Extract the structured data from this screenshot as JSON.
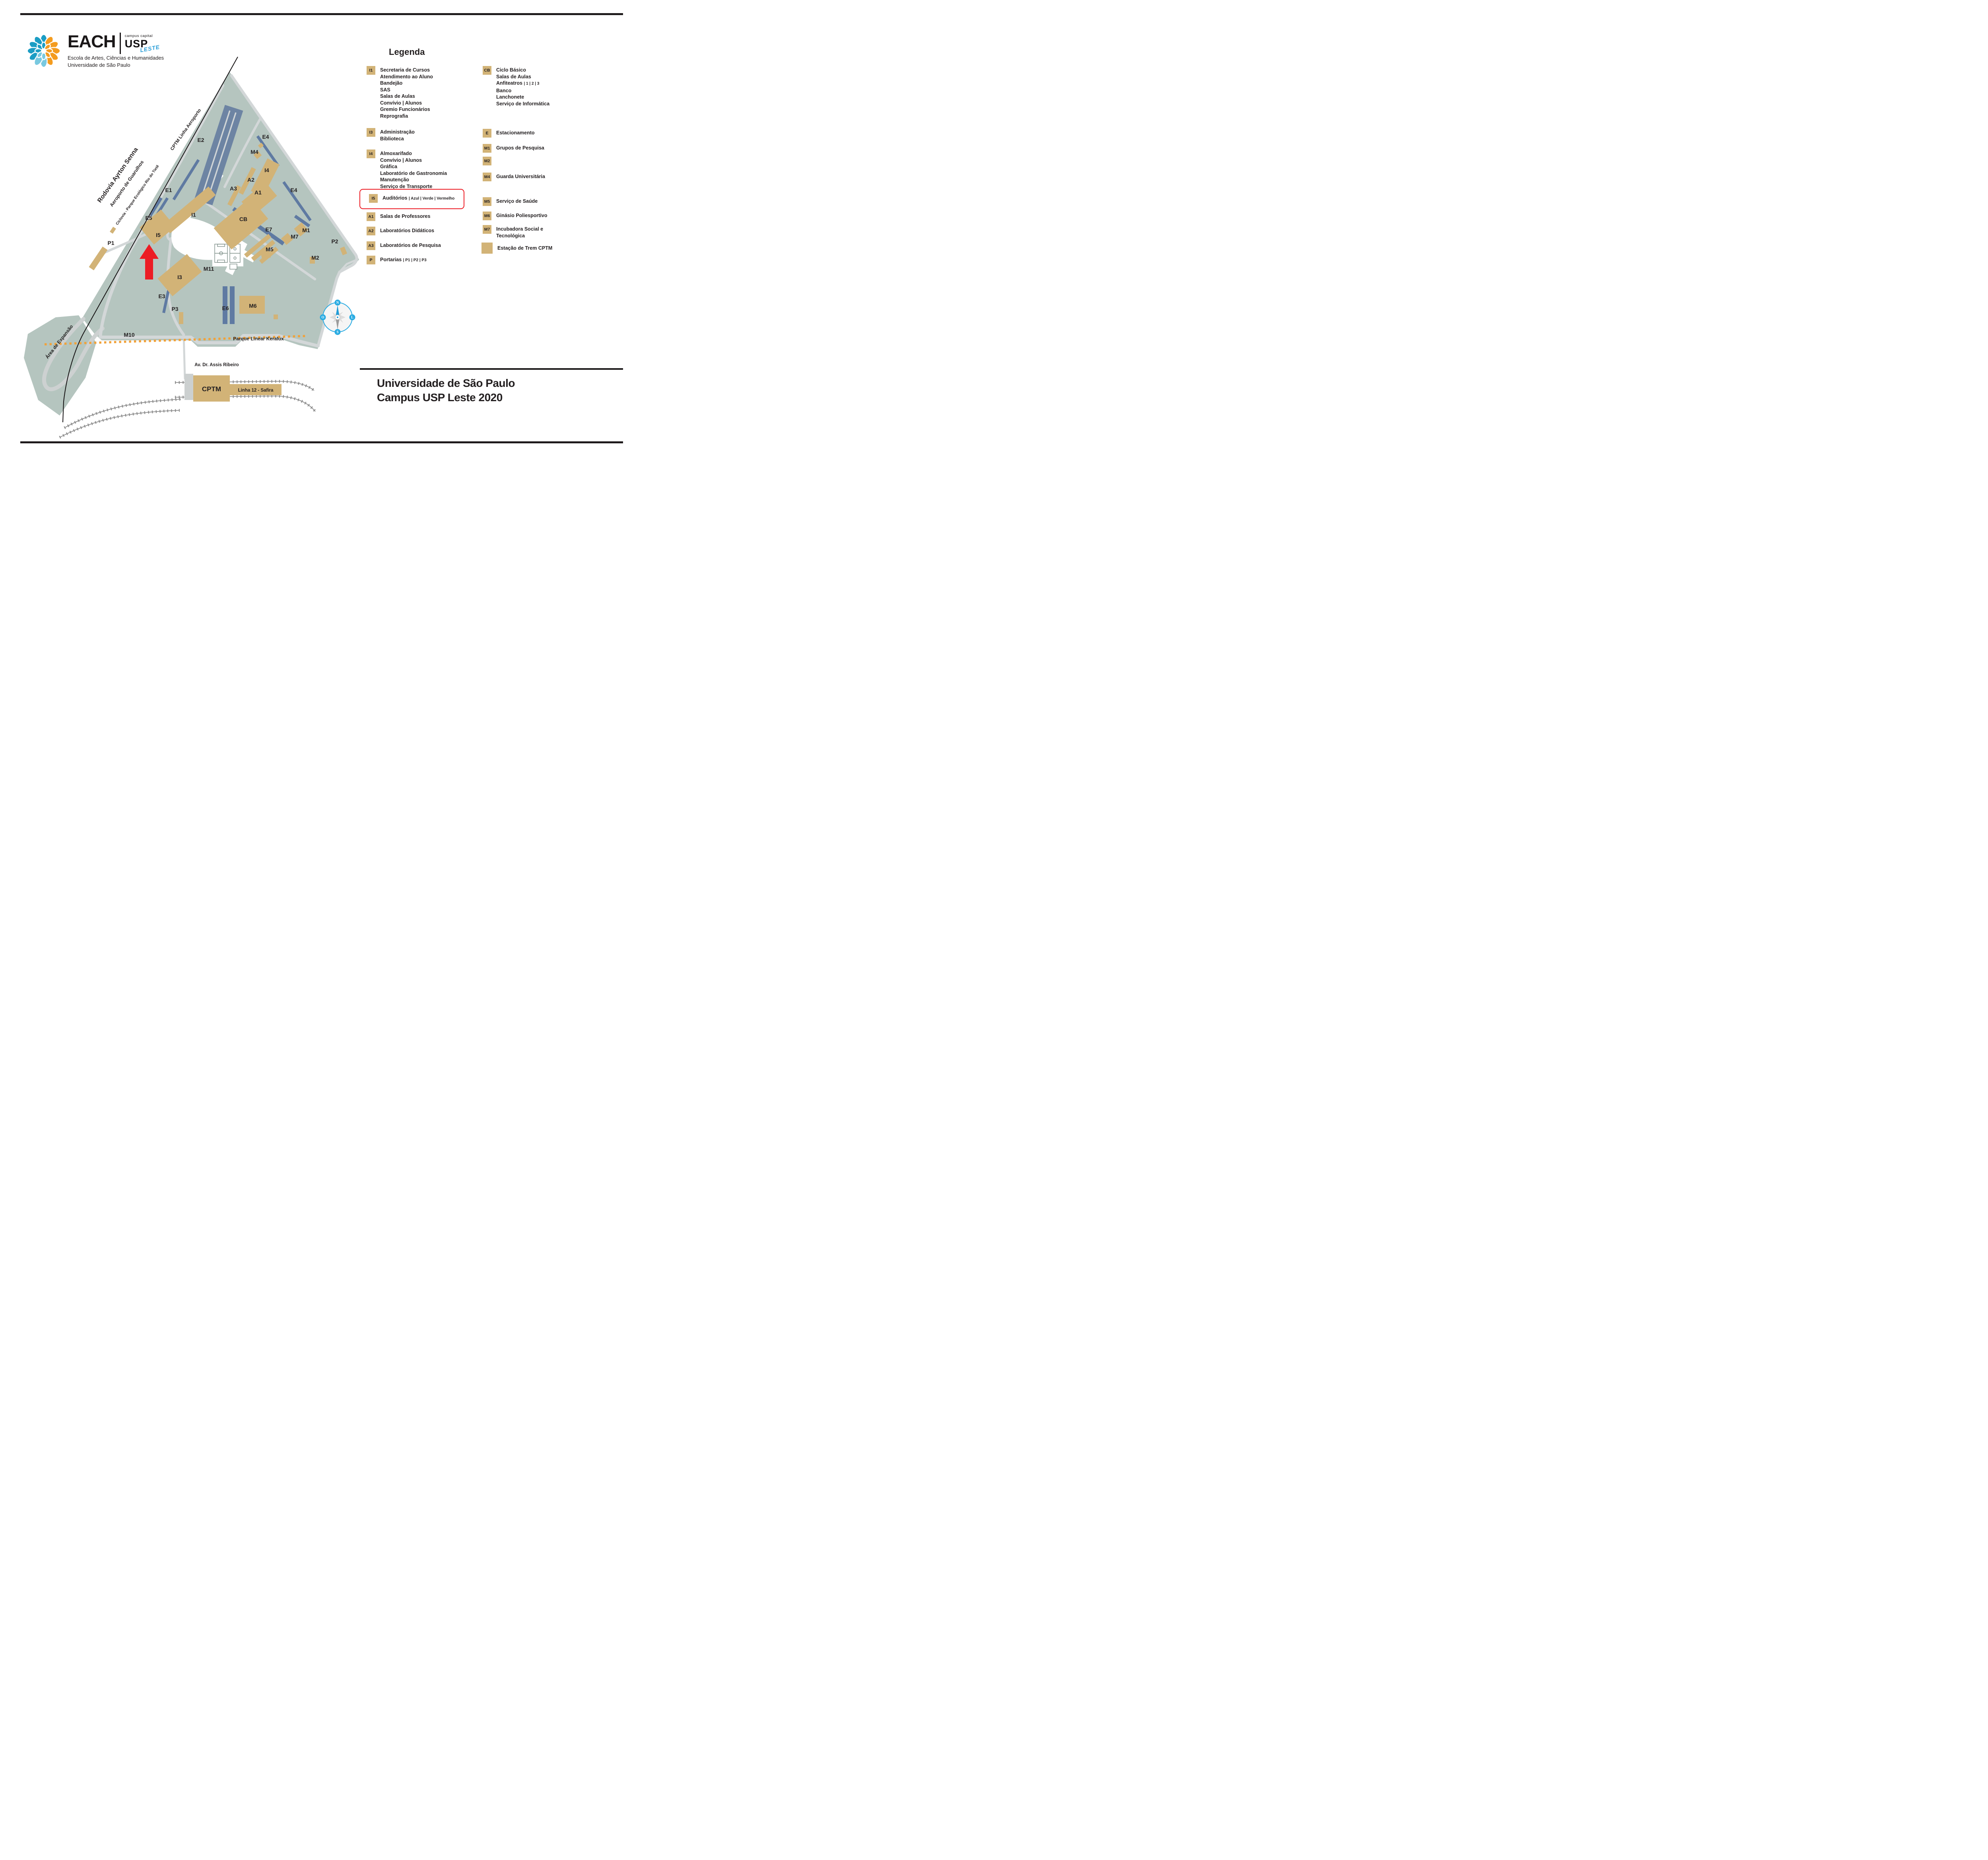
{
  "logo": {
    "acronym": "EACH",
    "campus_tag": "campus capital",
    "usp": "USP",
    "leste": "LESTE",
    "school_name": "Escola de Artes, Ciências e Humanidades",
    "university_name": "Universidade de São Paulo"
  },
  "legend": {
    "title": "Legenda",
    "col1": [
      {
        "code": "I1",
        "lines": [
          {
            "t": "Secretaria de Cursos",
            "s": ""
          },
          {
            "t": "Atendimento ao Aluno",
            "s": ""
          },
          {
            "t": "Bandejão",
            "s": ""
          },
          {
            "t": "SAS",
            "s": ""
          },
          {
            "t": "Salas de Aulas",
            "s": ""
          },
          {
            "t": "Convívio | Alunos",
            "s": ""
          },
          {
            "t": "Gremio Funcionários",
            "s": ""
          },
          {
            "t": "Reprografia",
            "s": ""
          }
        ]
      },
      {
        "code": "I3",
        "lines": [
          {
            "t": "Administração",
            "s": ""
          },
          {
            "t": "Biblioteca",
            "s": ""
          }
        ]
      },
      {
        "code": "I4",
        "lines": [
          {
            "t": "Almoxarifado",
            "s": ""
          },
          {
            "t": "Convívio | Alunos",
            "s": ""
          },
          {
            "t": "Gráfica",
            "s": ""
          },
          {
            "t": "Laboratório de Gastronomia",
            "s": ""
          },
          {
            "t": "Manutenção",
            "s": ""
          },
          {
            "t": "Serviço de Transporte",
            "s": ""
          }
        ]
      },
      {
        "code": "I5",
        "lines": [
          {
            "t": "Auditórios ",
            "s": "| Azul | Verde | Vermelho"
          }
        ],
        "highlighted": true
      },
      {
        "code": "A1",
        "lines": [
          {
            "t": "Salas de Professores",
            "s": ""
          }
        ]
      },
      {
        "code": "A2",
        "lines": [
          {
            "t": "Laboratórios Didáticos",
            "s": ""
          }
        ]
      },
      {
        "code": "A3",
        "lines": [
          {
            "t": "Laboratórios de Pesquisa",
            "s": ""
          }
        ]
      },
      {
        "code": "P",
        "lines": [
          {
            "t": "Portarias ",
            "s": "| P1 | P2 | P3"
          }
        ]
      }
    ],
    "col2": [
      {
        "code": "CB",
        "lines": [
          {
            "t": "Ciclo Básico",
            "s": ""
          },
          {
            "t": "Salas de Aulas",
            "s": ""
          },
          {
            "t": "Anfiteatros ",
            "s": "| 1 | 2 | 3"
          },
          {
            "t": "Banco",
            "s": ""
          },
          {
            "t": "Lanchonete",
            "s": ""
          },
          {
            "t": "Serviço de Informática",
            "s": ""
          }
        ]
      },
      {
        "code": "E",
        "lines": [
          {
            "t": "Estacionamento",
            "s": ""
          }
        ]
      },
      {
        "code": "M1",
        "lines": [
          {
            "t": "Grupos de Pesquisa",
            "s": ""
          }
        ]
      },
      {
        "code": "M2",
        "lines": []
      },
      {
        "code": "M4",
        "lines": [
          {
            "t": "Guarda Universitária",
            "s": ""
          }
        ]
      },
      {
        "code": "M5",
        "lines": [
          {
            "t": "Serviço de Saúde",
            "s": ""
          }
        ]
      },
      {
        "code": "M6",
        "lines": [
          {
            "t": "Ginásio Poliesportivo",
            "s": ""
          }
        ]
      },
      {
        "code": "M7",
        "lines": [
          {
            "t": "Incubadora Social e",
            "s": ""
          },
          {
            "t": "Tecnológica",
            "s": ""
          }
        ]
      },
      {
        "code": "",
        "lines": [
          {
            "t": "Estação de Trem CPTM",
            "s": ""
          }
        ]
      }
    ]
  },
  "map": {
    "labels": [
      {
        "text": "E2"
      },
      {
        "text": "E4"
      },
      {
        "text": "M4"
      },
      {
        "text": "I4"
      },
      {
        "text": "A2"
      },
      {
        "text": "A3"
      },
      {
        "text": "A1"
      },
      {
        "text": "E1"
      },
      {
        "text": "E4"
      },
      {
        "text": "E5"
      },
      {
        "text": "I1"
      },
      {
        "text": "CB"
      },
      {
        "text": "E7"
      },
      {
        "text": "M7"
      },
      {
        "text": "M1"
      },
      {
        "text": "P1"
      },
      {
        "text": "I5"
      },
      {
        "text": "M5"
      },
      {
        "text": "P2"
      },
      {
        "text": "M2"
      },
      {
        "text": "I3"
      },
      {
        "text": "M11"
      },
      {
        "text": "E3"
      },
      {
        "text": "P3"
      },
      {
        "text": "E6"
      },
      {
        "text": "M6"
      },
      {
        "text": "M10"
      }
    ],
    "roads": {
      "rodovia": "Rodovia Ayrton Senna",
      "aeroporto": "Aeroporto de Guarulhos",
      "ciclovia": "Ciclovia - Parque Ecológico Rio do Tietê",
      "cptm_linha": "CPTM Linha Aeroporto",
      "avenida": "Av. Dr. Assis Ribeiro",
      "parque": "Parque Linear Keralux",
      "area_expansao": "Área de Expansão"
    },
    "station": {
      "name": "CPTM",
      "line": "Linha 12 - Safira"
    },
    "compass": {
      "n": "N",
      "s": "S",
      "o": "O",
      "l": "L"
    },
    "colors": {
      "campus_green": "#b5c5bf",
      "building_tan": "#d2b377",
      "parking_blue": "#6d84a3",
      "strip_blue": "#5f7aa2",
      "road_gray": "#d3d7d8",
      "highlight_red": "#ec1c24",
      "rail_gray": "#8a8a8a",
      "park_orange": "#f0a23b",
      "compass_blue": "#29abe2"
    }
  },
  "footer": {
    "title_line1": "Universidade de São Paulo",
    "title_line2": "Campus USP Leste 2020"
  }
}
